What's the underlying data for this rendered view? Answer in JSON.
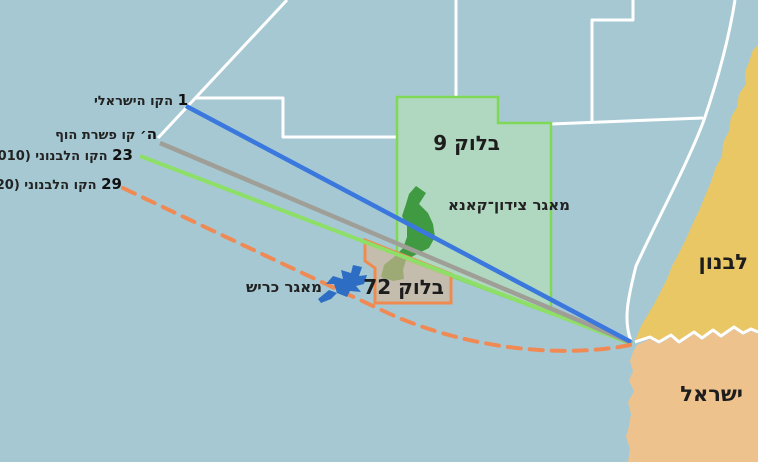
{
  "map_title": "Israel-Lebanon maritime border dispute map",
  "legend_lines": [
    {
      "number": "1",
      "label": "הקו הישראלי",
      "color": "#3a78dd",
      "style": "solid"
    },
    {
      "number": "ה׳",
      "label": "קו פשרת הוף",
      "color": "#9f9f98",
      "style": "solid"
    },
    {
      "number": "23",
      "label": "הקו הלבנוני (2010)",
      "color": "#8ddf68",
      "style": "solid"
    },
    {
      "number": "29",
      "label": "הקו הלבנוני (2020)",
      "color": "#ef8a55",
      "style": "dashed"
    }
  ],
  "blocks": [
    {
      "label": "בלוק 9",
      "fill": "#b0d7bf",
      "border": "#7fd957"
    },
    {
      "label": "בלוק 72",
      "fill": "#d6b596",
      "border": "#ef8b50"
    }
  ],
  "fields": [
    {
      "label": "מאגר צידון־קאנא",
      "color": "#3f9a41"
    },
    {
      "label": "מאגר כריש",
      "color": "#2d6ec4"
    }
  ],
  "countries": [
    {
      "label": "לבנון",
      "land_color": "#e9c765"
    },
    {
      "label": "ישראל",
      "land_color": "#eec28c"
    }
  ],
  "colors": {
    "sea": "#a6c8d3",
    "zone_lines": "#ffffff",
    "lebanon_land": "#e9c765",
    "israel_land": "#eec28c",
    "block9_fill": "#b0d7bf",
    "block9_border": "#7fd957",
    "block72_fill": "#d6b596",
    "block72_border": "#ef8b50",
    "qana_green": "#3f9a41",
    "karish_blue": "#2d6ec4"
  }
}
